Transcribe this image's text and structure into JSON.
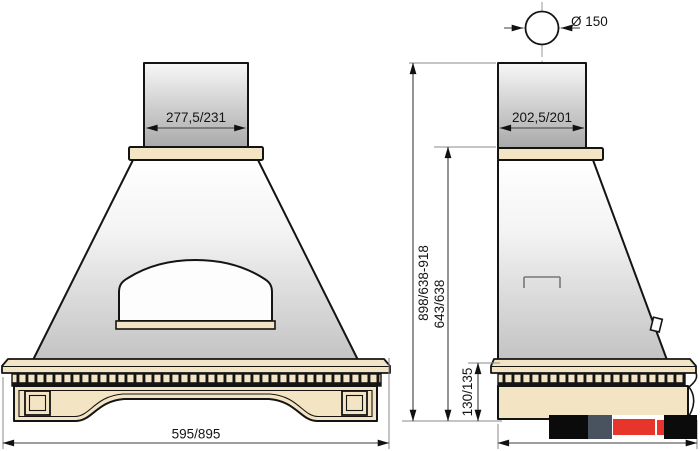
{
  "dimensions": {
    "front_chimney_width": "277,5/231",
    "front_total_width": "595/895",
    "duct_diameter": "Ø 150",
    "side_chimney_depth": "202,5/201",
    "total_height": "898/638-918",
    "body_height": "643/638",
    "cornice_height": "130/135"
  },
  "colors": {
    "wood": "#f3e4c4",
    "outline": "#141414",
    "dimension_line": "#3d3d3d",
    "extension_line": "#8a8a8a",
    "logo_black": "#0b0b0b",
    "logo_slate": "#49525f",
    "logo_red": "#e8352b"
  }
}
